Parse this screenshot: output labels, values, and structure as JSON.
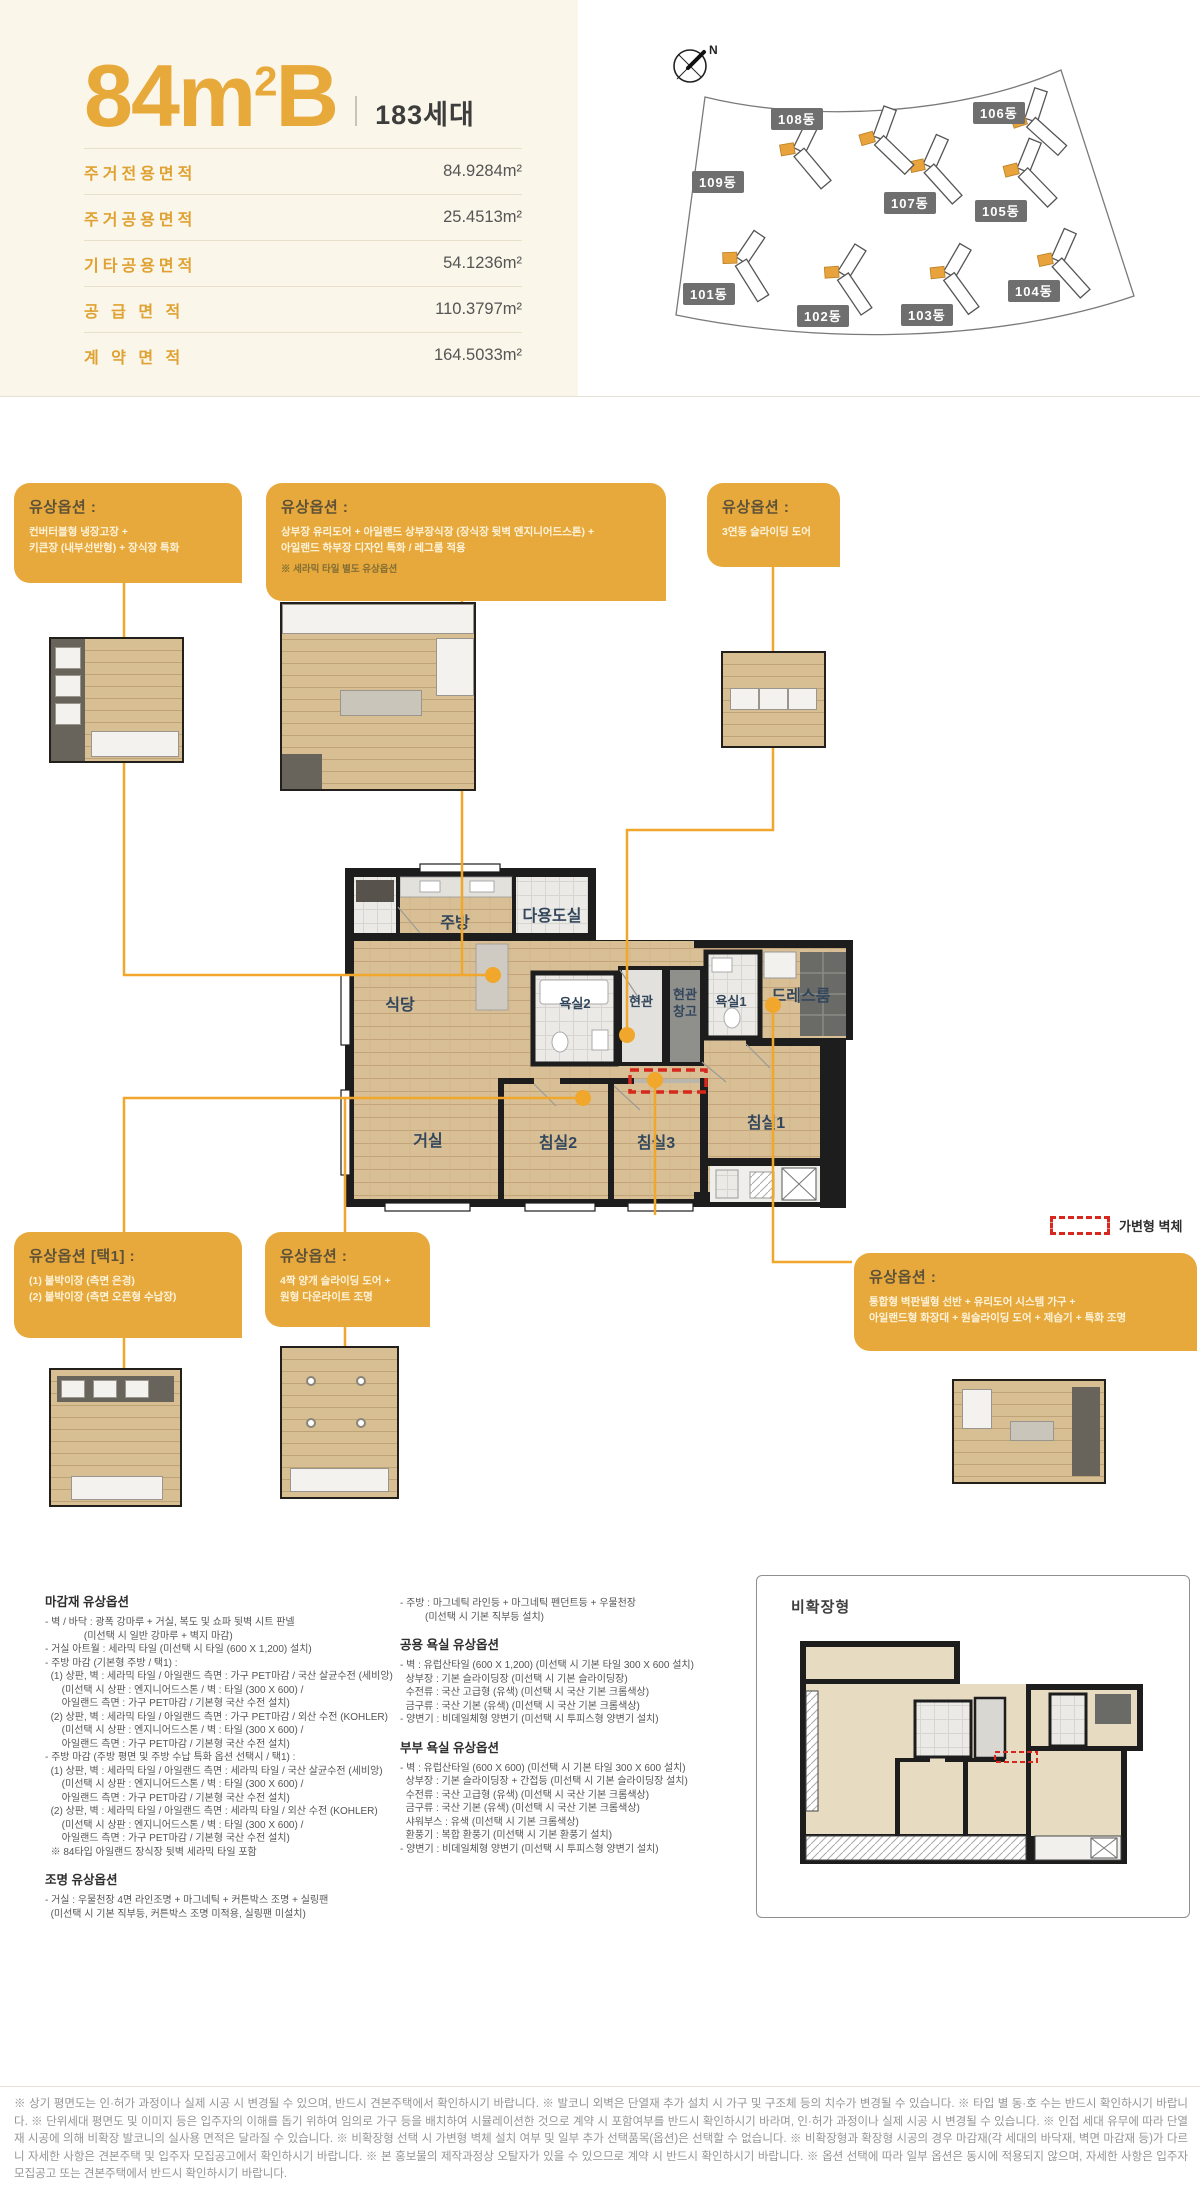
{
  "header": {
    "title_number": "84",
    "title_unit_base": "m",
    "title_unit_sup": "2",
    "title_variant": "B",
    "households": "183세대",
    "area_table": [
      {
        "label": "주거전용면적",
        "value": "84.9284m²"
      },
      {
        "label": "주거공용면적",
        "value": "25.4513m²"
      },
      {
        "label": "기타공용면적",
        "value": "54.1236m²"
      },
      {
        "label": "공 급 면 적",
        "value": "110.3797m²"
      },
      {
        "label": "계 약 면 적",
        "value": "164.5033m²"
      }
    ]
  },
  "site_plan": {
    "compass_label": "N",
    "buildings": [
      {
        "name": "101동"
      },
      {
        "name": "102동"
      },
      {
        "name": "103동"
      },
      {
        "name": "104동"
      },
      {
        "name": "105동"
      },
      {
        "name": "106동"
      },
      {
        "name": "107동"
      },
      {
        "name": "108동"
      },
      {
        "name": "109동"
      }
    ]
  },
  "floor_plan": {
    "rooms": {
      "kitchen": "주방",
      "utility": "다용도실",
      "dining": "식당",
      "bath2": "욕실2",
      "entry": "현관",
      "entry_storage_1": "현관",
      "entry_storage_2": "창고",
      "bath1": "욕실1",
      "dress": "드레스룸",
      "living": "거실",
      "bed2": "침실2",
      "bed3": "침실3",
      "bed1": "침실1"
    }
  },
  "legend": {
    "label": "가변형 벽체"
  },
  "option_boxes": [
    {
      "title": "유상옵션 :",
      "lines": [
        "컨버터블형 냉장고장 +",
        "키큰장 (내부선반형) + 장식장 특화"
      ]
    },
    {
      "title": "유상옵션 :",
      "lines": [
        "상부장 유리도어 + 아일랜드 상부장식장 (장식장 뒷벽 엔지니어드스톤) +",
        "아일랜드 하부장 디자인 특화 / 레그룸 적용"
      ],
      "note": "※ 세라믹 타일 별도 유상옵션"
    },
    {
      "title": "유상옵션 :",
      "lines": [
        "3연동 슬라이딩 도어"
      ]
    },
    {
      "title": "유상옵션 [택1] :",
      "lines": [
        "(1) 붙박이장 (측면 은경)",
        "(2) 붙박이장 (측면 오픈형 수납장)"
      ]
    },
    {
      "title": "유상옵션 :",
      "lines": [
        "4짝 양개 슬라이딩 도어 +",
        "원형 다운라이트 조명"
      ]
    },
    {
      "title": "유상옵션 :",
      "lines": [
        "통합형 벽판넬형 선반 + 유리도어 시스템 가구 +",
        "아일랜드형 화장대 + 원슬라이딩 도어 + 제습기 + 특화 조명"
      ]
    }
  ],
  "specs": {
    "finish": {
      "title": "마감재 유상옵션",
      "lines": [
        "- 벽 / 바닥 : 광폭 강마루 + 거실, 복도 및 쇼파 뒷벽 시트 판넬",
        "              (미선택 시 일반 강마루 + 벽지 마감)",
        "- 거실 아트월 : 세라믹 타일 (미선택 시 타일 (600 X 1,200) 설치)",
        "- 주방 마감 (기본형 주방 / 택1) :",
        "  (1) 상판, 벽 : 세라믹 타일 / 아일랜드 측면 : 가구 PET마감 / 국산 살균수전 (세비앙)",
        "      (미선택 시 상판 : 엔지니어드스톤 / 벽 : 타일 (300 X 600) /",
        "      아일랜드 측면 : 가구 PET마감 / 기본형 국산 수전 설치)",
        "  (2) 상판, 벽 : 세라믹 타일 / 아일랜드 측면 : 가구 PET마감 / 외산 수전 (KOHLER)",
        "      (미선택 시 상판 : 엔지니어드스톤 / 벽 : 타일 (300 X 600) /",
        "      아일랜드 측면 : 가구 PET마감 / 기본형 국산 수전 설치)",
        "- 주방 마감 (주방 평면 및 주방 수납 특화 옵션 선택시 / 택1) :",
        "  (1) 상판, 벽 : 세라믹 타일 / 아일랜드 측면 : 세라믹 타일 / 국산 살균수전 (세비앙)",
        "      (미선택 시 상판 : 엔지니어드스톤 / 벽 : 타일 (300 X 600) /",
        "      아일랜드 측면 : 가구 PET마감 / 기본형 국산 수전 설치)",
        "  (2) 상판, 벽 : 세라믹 타일 / 아일랜드 측면 : 세라믹 타일 / 외산 수전 (KOHLER)",
        "      (미선택 시 상판 : 엔지니어드스톤 / 벽 : 타일 (300 X 600) /",
        "      아일랜드 측면 : 가구 PET마감 / 기본형 국산 수전 설치)",
        "  ※ 84타입 아일랜드 장식장 뒷벽 세라믹 타일 포함"
      ]
    },
    "lighting": {
      "title": "조명 유상옵션",
      "lines": [
        "- 거실 : 우물천장 4면 라인조명 + 마그네틱 + 커튼박스 조명 + 실링팬",
        "  (미선택 시 기본 직부등, 커튼박스 조명 미적용, 실링팬 미설치)"
      ]
    },
    "lighting_kitchen": {
      "lines": [
        "- 주방 : 마그네틱 라인등 + 마그네틱 펜던트등 + 우물천장",
        "         (미선택 시 기본 직부등 설치)"
      ]
    },
    "common_bath": {
      "title": "공용 욕실 유상옵션",
      "lines": [
        "- 벽 : 유럽산타일 (600 X 1,200) (미선택 시 기본 타일 300 X 600 설치)",
        "  상부장 : 기본 슬라이딩장 (미선택 시 기본 슬라이딩장)",
        "  수전류 : 국산 고급형 (유색) (미선택 시 국산 기본 크롬색상)",
        "  금구류 : 국산 기본 (유색) (미선택 시 국산 기본 크롬색상)",
        "- 양변기 : 비데일체형 양변기 (미선택 시 투피스형 양변기 설치)"
      ]
    },
    "master_bath": {
      "title": "부부 욕실 유상옵션",
      "lines": [
        "- 벽 : 유럽산타일 (600 X 600) (미선택 시 기본 타일 300 X 600 설치)",
        "  상부장 : 기본 슬라이딩장 + 간접등 (미선택 시 기본 슬라이딩장 설치)",
        "  수전류 : 국산 고급형 (유색) (미선택 시 국산 기본 크롬색상)",
        "  금구류 : 국산 기본 (유색) (미선택 시 국산 기본 크롬색상)",
        "  샤워부스 : 유색 (미선택 시 기본 크롬색상)",
        "  환풍기 : 복합 환풍기 (미선택 시 기본 환풍기 설치)",
        "- 양변기 : 비데일체형 양변기 (미선택 시 투피스형 양변기 설치)"
      ]
    }
  },
  "non_expanded": {
    "title": "비확장형"
  },
  "footer": {
    "disclaimer": "※ 상기 평면도는 인·허가 과정이나 실제 시공 시 변경될 수 있으며, 반드시 견본주택에서 확인하시기 바랍니다. ※ 발코니 외벽은 단열재 추가 설치 시 가구 및 구조체 등의 치수가 변경될 수 있습니다. ※ 타입 별 동·호 수는 반드시 확인하시기 바랍니다. ※ 단위세대 평면도 및 이미지 등은 입주자의 이해를 돕기 위하여 임의로 가구 등을 배치하여 시뮬레이션한 것으로 계약 시 포함여부를 반드시 확인하시기 바라며, 인·허가 과정이나 실제 시공 시 변경될 수 있습니다. ※ 인접 세대 유무에 따라 단열재 시공에 의해 비확장 발코니의 실사용 면적은 달라질 수 있습니다. ※ 비확장형 선택 시 가변형 벽체 설치 여부 및 일부 추가 선택품목(옵션)은 선택할 수 없습니다. ※ 비확장형과 확장형 시공의 경우 마감재(각 세대의 바닥재, 벽면 마감재 등)가 다르니 자세한 사항은 견본주택 및 입주자 모집공고에서 확인하시기 바랍니다. ※ 본 홍보물의 제작과정상 오탈자가 있을 수 있으므로 계약 시 반드시 확인하시기 바랍니다. ※ 옵션 선택에 따라 일부 옵션은 동시에 적용되지 않으며, 자세한 사항은 입주자 모집공고 또는 견본주택에서 반드시 확인하시기 바랍니다."
  },
  "colors": {
    "accent_gold": "#e8a93b",
    "box_gold": "#e7a93c",
    "connector_gold": "#f0a72b",
    "variable_wall_red": "#d6281c",
    "badge_gray": "#6f6f6f",
    "wood_floor": "#d8be93",
    "cream_bg": "#fbf6ea"
  }
}
